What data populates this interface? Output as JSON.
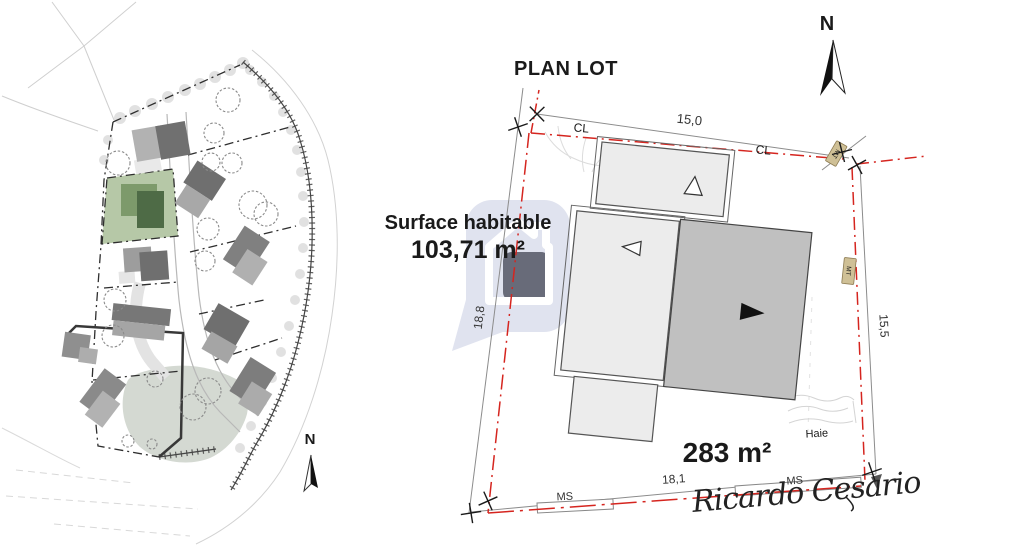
{
  "title": "PLAN LOT",
  "surface": {
    "label": "Surface habitable",
    "value": "103,71 m²"
  },
  "lot": {
    "area": "283 m²",
    "dim_top": "15,0",
    "dim_left": "18,8",
    "dim_right": "15,5",
    "dim_bottom": "18,1",
    "label_cl_1": "CL",
    "label_cl_2": "CL",
    "label_mt_1": "MT",
    "label_mt_2": "MT",
    "label_ms_1": "MS",
    "label_ms_2": "MS",
    "label_haie": "Haie"
  },
  "compass": {
    "plan_north": "N",
    "map_north": "N"
  },
  "signature": "Ricardo Cesario",
  "icons": {
    "north_arrow": "north-arrow",
    "watermark_logo": "house-in-rounded-square-speech-bubble"
  },
  "colors": {
    "boundary_red": "#d5251f",
    "building_light": "#ececec",
    "building_dark": "#c0c0c0",
    "plot_green": "#b6c8a7",
    "house_green_light": "#7d9a6b",
    "house_green_dark": "#4e6b46",
    "marker_tan": "#cfc096",
    "watermark_fill": "#e0e3ef",
    "watermark_inner": "#686b79"
  }
}
